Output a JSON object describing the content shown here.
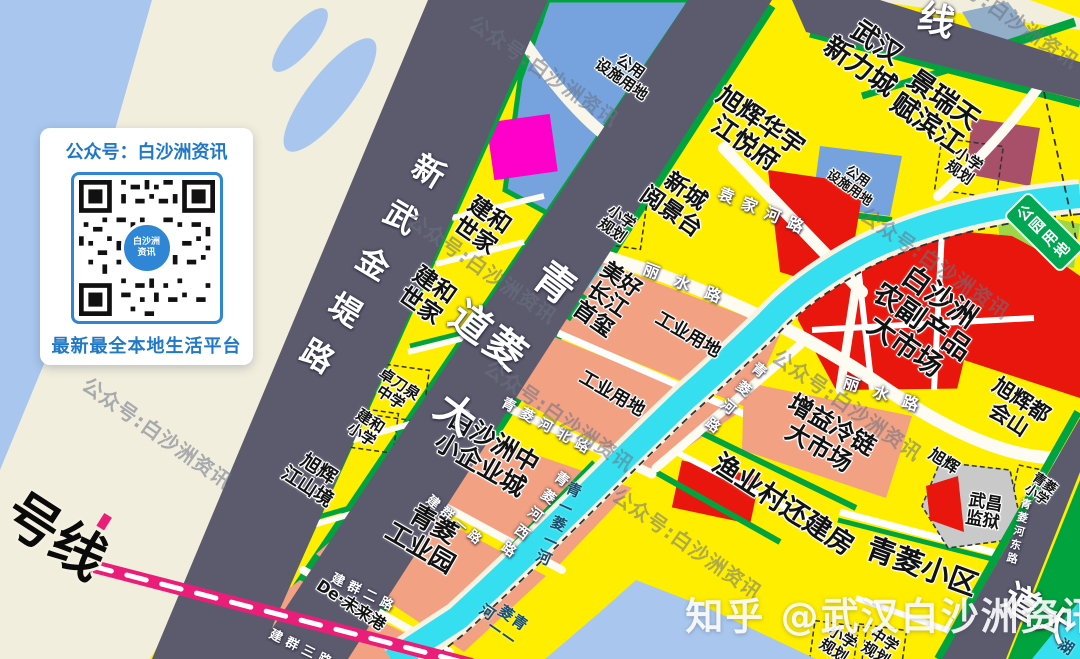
{
  "qr_card": {
    "title": "公众号：白沙洲资讯",
    "footer": "最新最全本地生活平台",
    "center_text": "白沙洲\n资讯"
  },
  "watermark": {
    "text": "公众号:白沙洲资讯",
    "rotate": 35,
    "positions": [
      {
        "x": 545,
        "y": 70
      },
      {
        "x": 483,
        "y": 267
      },
      {
        "x": 560,
        "y": 415
      },
      {
        "x": 688,
        "y": 543
      },
      {
        "x": 158,
        "y": 432
      },
      {
        "x": 936,
        "y": 262
      },
      {
        "x": 848,
        "y": 404
      },
      {
        "x": 1005,
        "y": 12
      }
    ]
  },
  "zhihu_watermark": {
    "text": "知乎 @武汉白沙洲资讯"
  },
  "map": {
    "park_badge": {
      "text": "公园\n用地"
    },
    "palette": {
      "parcel_yellow": "#ffee00",
      "industry_salmon": "#f2a183",
      "market_red": "#e8160c",
      "green_strip": "#00a33e",
      "park_light_green": "#9ed64a",
      "public_blue": "#76a3de",
      "river_cyan": "#35dff0",
      "water_blue": "#a9c7ee",
      "bank_beige": "#f2eedd",
      "road_dark": "#5c5b6e",
      "magenta": "#ff00cb",
      "maroon": "#a8506a",
      "metro_pink": "#ea1e79",
      "prison_gray": "#c9c9c9",
      "qr_blue": "#2e86d4"
    },
    "labels": [
      {
        "n": "label-wuhan-xinlicheng",
        "t": "武汉\n新力城",
        "x": 868,
        "y": 55,
        "s": 27,
        "r": 35
      },
      {
        "n": "label-jingrui-tianfu-binjiang",
        "t": "景瑞天\n赋滨江",
        "x": 935,
        "y": 112,
        "s": 27,
        "r": 35
      },
      {
        "n": "label-xiaoxue-guihua-1",
        "t": "小学\n规划",
        "x": 964,
        "y": 166,
        "s": 15,
        "r": 35
      },
      {
        "n": "label-gongyong-sheshi-yongdi-1",
        "t": "公用\n设施用地",
        "x": 626,
        "y": 73,
        "s": 15,
        "r": 35
      },
      {
        "n": "label-xuhui-huayu-jiangyuefu",
        "t": "旭辉华宇\n江悦府",
        "x": 753,
        "y": 132,
        "s": 25,
        "r": 35
      },
      {
        "n": "label-xincheng-yuejingtai",
        "t": "新城\n阅景台",
        "x": 678,
        "y": 202,
        "s": 23,
        "r": 35
      },
      {
        "n": "label-xiaoxue-guihua-2",
        "t": "小学\n规划",
        "x": 617,
        "y": 224,
        "s": 15,
        "r": 35
      },
      {
        "n": "label-gongyong-sheshi-yongdi-2",
        "t": "公用\n设施用地",
        "x": 853,
        "y": 183,
        "s": 13,
        "r": 35
      },
      {
        "n": "label-jianhe-shijia-1",
        "t": "建和\n世家",
        "x": 482,
        "y": 226,
        "s": 23,
        "r": 35
      },
      {
        "n": "label-jianhe-shijia-2",
        "t": "建和\n世家",
        "x": 427,
        "y": 296,
        "s": 23,
        "r": 35
      },
      {
        "n": "label-meihao-changjiang-shouxi",
        "t": "美好\n长江\n首玺",
        "x": 607,
        "y": 300,
        "s": 22,
        "r": 35
      },
      {
        "n": "label-gongye-yongdi-1",
        "t": "工业用地",
        "x": 688,
        "y": 335,
        "s": 18,
        "r": 30
      },
      {
        "n": "label-gongye-yongdi-2",
        "t": "工业用地",
        "x": 612,
        "y": 394,
        "s": 18,
        "r": 30
      },
      {
        "n": "label-baishazhou-nongfuchanpin-dashichang",
        "t": "白沙洲\n农副产品\n大市场",
        "x": 922,
        "y": 322,
        "s": 28,
        "r": 35
      },
      {
        "n": "label-xuhui-duhuishan",
        "t": "旭辉都会山",
        "x": 1015,
        "y": 410,
        "s": 21,
        "r": 33
      },
      {
        "n": "label-zengyi-lenglian-dashichang",
        "t": "增益冷链\n大市场",
        "x": 825,
        "y": 437,
        "s": 24,
        "r": 30
      },
      {
        "n": "label-yuyecun-huanjianfang",
        "t": "渔业村还建房",
        "x": 783,
        "y": 505,
        "s": 27,
        "r": 33
      },
      {
        "n": "label-xuhui",
        "t": "旭辉",
        "x": 944,
        "y": 461,
        "s": 16,
        "r": 33
      },
      {
        "n": "label-wuchang-jianyu",
        "t": "武昌\n监狱",
        "x": 984,
        "y": 512,
        "s": 17,
        "r": 10
      },
      {
        "n": "label-qingling-xiaoxue",
        "t": "青菱\n小学",
        "x": 1040,
        "y": 490,
        "s": 13,
        "r": 35
      },
      {
        "n": "label-qingling-xiaoqu",
        "t": "青菱小区",
        "x": 922,
        "y": 567,
        "s": 29,
        "r": 20
      },
      {
        "n": "label-zhuodaoquan-zhongxue",
        "t": "卓刀泉\n中学",
        "x": 395,
        "y": 391,
        "s": 15,
        "r": 33
      },
      {
        "n": "label-jianhe-xiaoxue",
        "t": "建和\n小学",
        "x": 366,
        "y": 428,
        "s": 15,
        "r": 33
      },
      {
        "n": "label-xuhui-jiangshanjing",
        "t": "旭辉\n江山境",
        "x": 313,
        "y": 478,
        "s": 19,
        "r": 33
      },
      {
        "n": "label-baishazhou-zhongxiao-qiyecheng",
        "t": "白沙洲中\n小企业城",
        "x": 487,
        "y": 453,
        "s": 25,
        "r": 30
      },
      {
        "n": "label-qingling-gongyeyuan",
        "t": "青菱\n工业园",
        "x": 427,
        "y": 536,
        "s": 25,
        "r": 30
      },
      {
        "n": "label-de-weilaigang",
        "t": "De·未来港",
        "x": 351,
        "y": 605,
        "s": 16,
        "r": 33
      },
      {
        "n": "label-xiaoxue-guihua-3",
        "t": "小学\n规划",
        "x": 838,
        "y": 644,
        "s": 15,
        "r": 33
      },
      {
        "n": "label-zhongxue-guihua",
        "t": "中学\n规划",
        "x": 880,
        "y": 647,
        "s": 15,
        "r": 33
      },
      {
        "n": "label-hu",
        "t": "湖",
        "x": 1066,
        "y": 647,
        "s": 15,
        "r": 33,
        "k": "river"
      },
      {
        "n": "label-road-xinwujindilu",
        "t": "新武金堤路",
        "x": 366,
        "y": 271,
        "s": 32,
        "r": 31,
        "k": "road",
        "v": 1,
        "ls": 22
      },
      {
        "n": "label-road-qingling-dadao",
        "t": "青菱大道",
        "x": 473,
        "y": 348,
        "s": 40,
        "r": 37,
        "k": "road",
        "v": 1,
        "ls": 42
      },
      {
        "n": "label-road-yuanjiahelu",
        "t": "袁家河路",
        "x": 765,
        "y": 212,
        "s": 16,
        "r": 23,
        "k": "road",
        "ls": 9
      },
      {
        "n": "label-road-lishuilu-1",
        "t": "丽水路",
        "x": 690,
        "y": 286,
        "s": 16,
        "r": 21,
        "k": "road",
        "ls": 17
      },
      {
        "n": "label-road-lishuilu-2",
        "t": "丽水路",
        "x": 888,
        "y": 396,
        "s": 16,
        "r": 18,
        "k": "road",
        "ls": 15
      },
      {
        "n": "label-road-qinglinghelu",
        "t": "青菱河路",
        "x": 732,
        "y": 400,
        "s": 14,
        "r": 40,
        "k": "road",
        "v": 1,
        "ls": 10
      },
      {
        "n": "label-road-qinglinghe-beilu",
        "t": "青菱河北路",
        "x": 548,
        "y": 428,
        "s": 14,
        "r": 29,
        "k": "road",
        "ls": 7
      },
      {
        "n": "label-road-qinglinghe-xilu",
        "t": "青菱河西路",
        "x": 532,
        "y": 516,
        "s": 14,
        "r": 37,
        "k": "road",
        "v": 1,
        "ls": 8
      },
      {
        "n": "label-road-qinglinghe-donglu",
        "t": "青菱河东路",
        "x": 1018,
        "y": 532,
        "s": 11,
        "r": 14,
        "k": "road",
        "v": 1,
        "ls": 3
      },
      {
        "n": "label-road-jianqun-yilu",
        "t": "建群一路",
        "x": 455,
        "y": 522,
        "s": 13,
        "r": 40,
        "k": "road",
        "ls": 5
      },
      {
        "n": "label-road-jianqun-erlu",
        "t": "建群二路",
        "x": 364,
        "y": 594,
        "s": 13,
        "r": 26,
        "k": "road",
        "ls": 5
      },
      {
        "n": "label-road-jianqun-sanlu",
        "t": "建群三路",
        "x": 302,
        "y": 650,
        "s": 13,
        "r": 26,
        "k": "road",
        "ls": 5
      },
      {
        "n": "label-road-ring-xian",
        "t": "线",
        "x": 936,
        "y": 22,
        "s": 36,
        "r": 15,
        "k": "road"
      },
      {
        "n": "label-road-dadao",
        "t": "大道",
        "x": 1030,
        "y": 617,
        "s": 36,
        "r": 32,
        "k": "road",
        "v": 1,
        "ls": 18
      },
      {
        "n": "label-metro-haoxian",
        "t": "号线",
        "x": 55,
        "y": 537,
        "s": 54,
        "r": 33,
        "k": "metro"
      },
      {
        "n": "label-river-qinglinghe-1",
        "t": "青—菱—河",
        "x": 558,
        "y": 524,
        "s": 15,
        "r": 24,
        "k": "river",
        "v": 1,
        "ls": 2
      },
      {
        "n": "label-river-qinglinghe-2",
        "t": "青—菱—河",
        "x": 500,
        "y": 621,
        "s": 15,
        "r": 35,
        "k": "river",
        "v": 1,
        "ls": 2
      }
    ]
  }
}
